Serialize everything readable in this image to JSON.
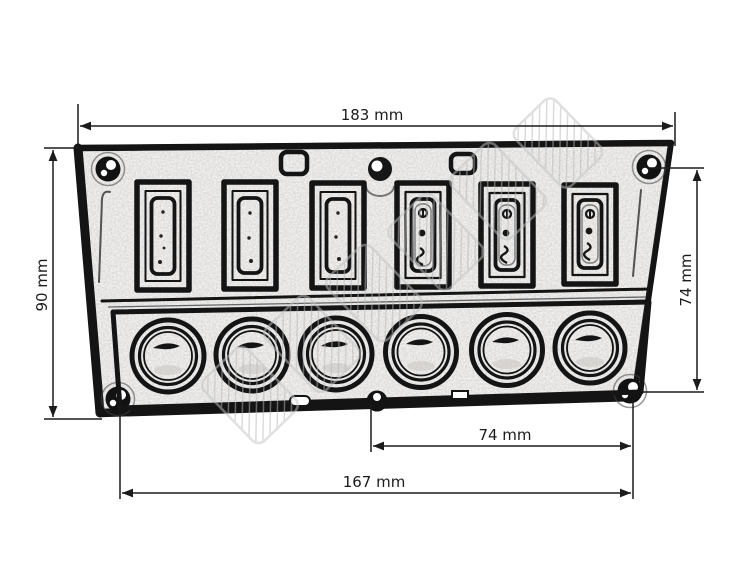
{
  "diagram": {
    "type": "technical-dimension-drawing",
    "subject": "6-gang rocker switch panel with 6 circular push buttons and 4 corner mounting screws",
    "units": "mm",
    "dimensions": {
      "overall_width": {
        "text": "183 mm",
        "value": 183,
        "position": "top-horizontal"
      },
      "overall_height": {
        "text": "90 mm",
        "value": 90,
        "position": "left-vertical"
      },
      "screw_span_vertical": {
        "text": "74 mm",
        "value": 74,
        "position": "right-vertical"
      },
      "center_to_screw": {
        "text": "74 mm",
        "value": 74,
        "position": "bottom-upper-horizontal"
      },
      "screw_span_horizontal": {
        "text": "167 mm",
        "value": 167,
        "position": "bottom-lower-horizontal"
      }
    },
    "panel": {
      "rocker_switch_count": 6,
      "push_button_count": 6,
      "corner_screw_count": 4,
      "switches_with_markings": [
        4,
        5,
        6
      ],
      "watermark_present": true,
      "watermark_legible": false
    },
    "colors": {
      "line": "#141414",
      "dimension_line": "#1b1b1b",
      "background": "#ffffff",
      "panel_face": "#f5f3f0",
      "watermark": "#c2c2c2"
    }
  }
}
